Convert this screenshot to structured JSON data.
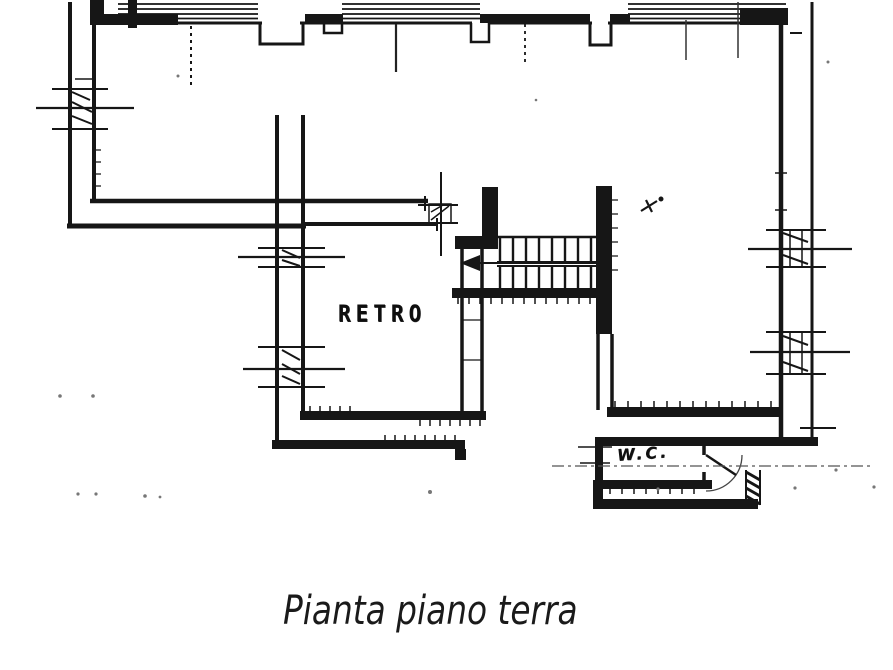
{
  "sheet": {
    "background": "#ffffff",
    "ink": "#161616",
    "centerline_color": "#555555"
  },
  "plan": {
    "caption": "Pianta piano terra",
    "labels": {
      "retro": "RETRO",
      "wc": "W.C."
    }
  }
}
